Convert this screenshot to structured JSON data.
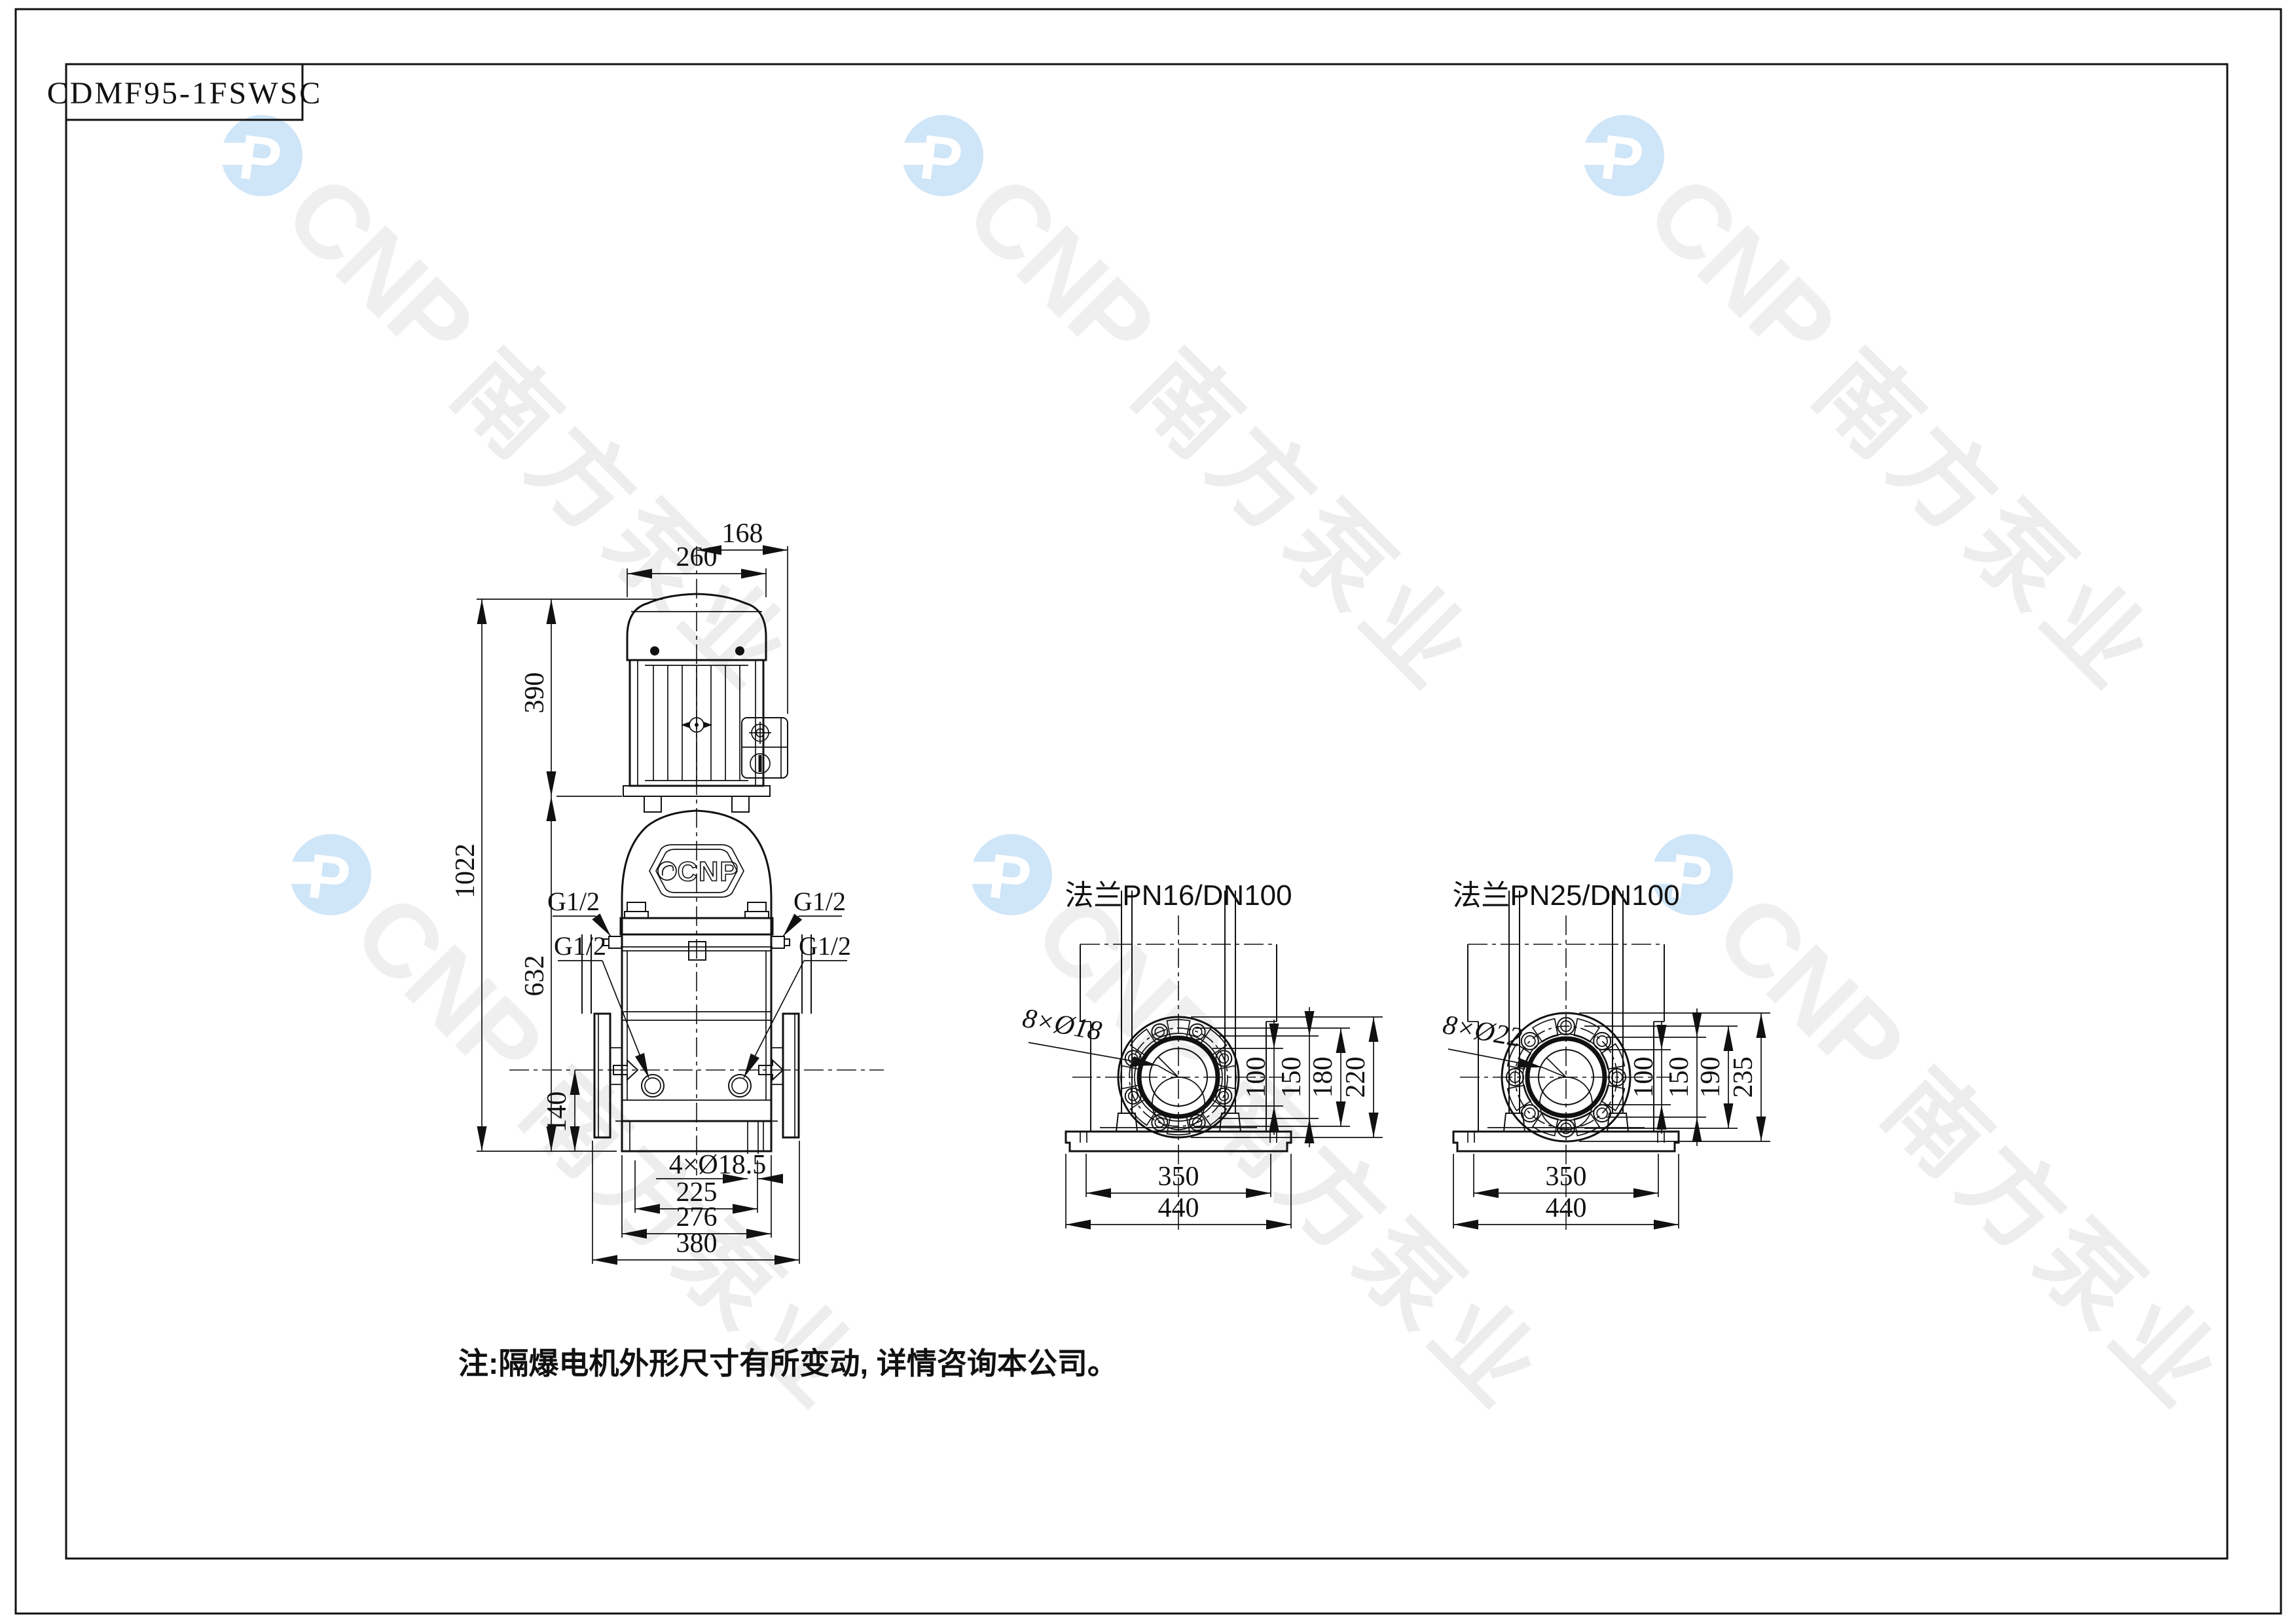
{
  "page": {
    "title_block": "CDMF95-1FSWSC",
    "note": "注:隔爆电机外形尺寸有所变动, 详情咨询本公司。"
  },
  "watermark": {
    "cnp": "CNP",
    "chinese": "南方泵业",
    "logo_color": "#cfe5f8",
    "text_color": "#efefef"
  },
  "front_view": {
    "badge_text": "CNP",
    "dims": {
      "motor_width": "260",
      "head_depth": "168",
      "motor_height": "390",
      "total_height": "1022",
      "pump_height": "632",
      "port_height": "140",
      "base_holes": "4×Ø18.5",
      "hole_span": "225",
      "base_width": "276",
      "overall_width": "380"
    },
    "port_labels": {
      "upper_left": "G1/2",
      "lower_left": "G1/2",
      "upper_right": "G1/2",
      "lower_right": "G1/2"
    }
  },
  "flange_views": [
    {
      "title": "法兰PN16/DN100",
      "bolt_label": "8×Ø18",
      "diameters": [
        "100",
        "150",
        "180",
        "220"
      ],
      "base_dims": [
        "350",
        "440"
      ]
    },
    {
      "title": "法兰PN25/DN100",
      "bolt_label": "8×Ø22",
      "diameters": [
        "100",
        "150",
        "190",
        "235"
      ],
      "base_dims": [
        "350",
        "440"
      ]
    }
  ]
}
